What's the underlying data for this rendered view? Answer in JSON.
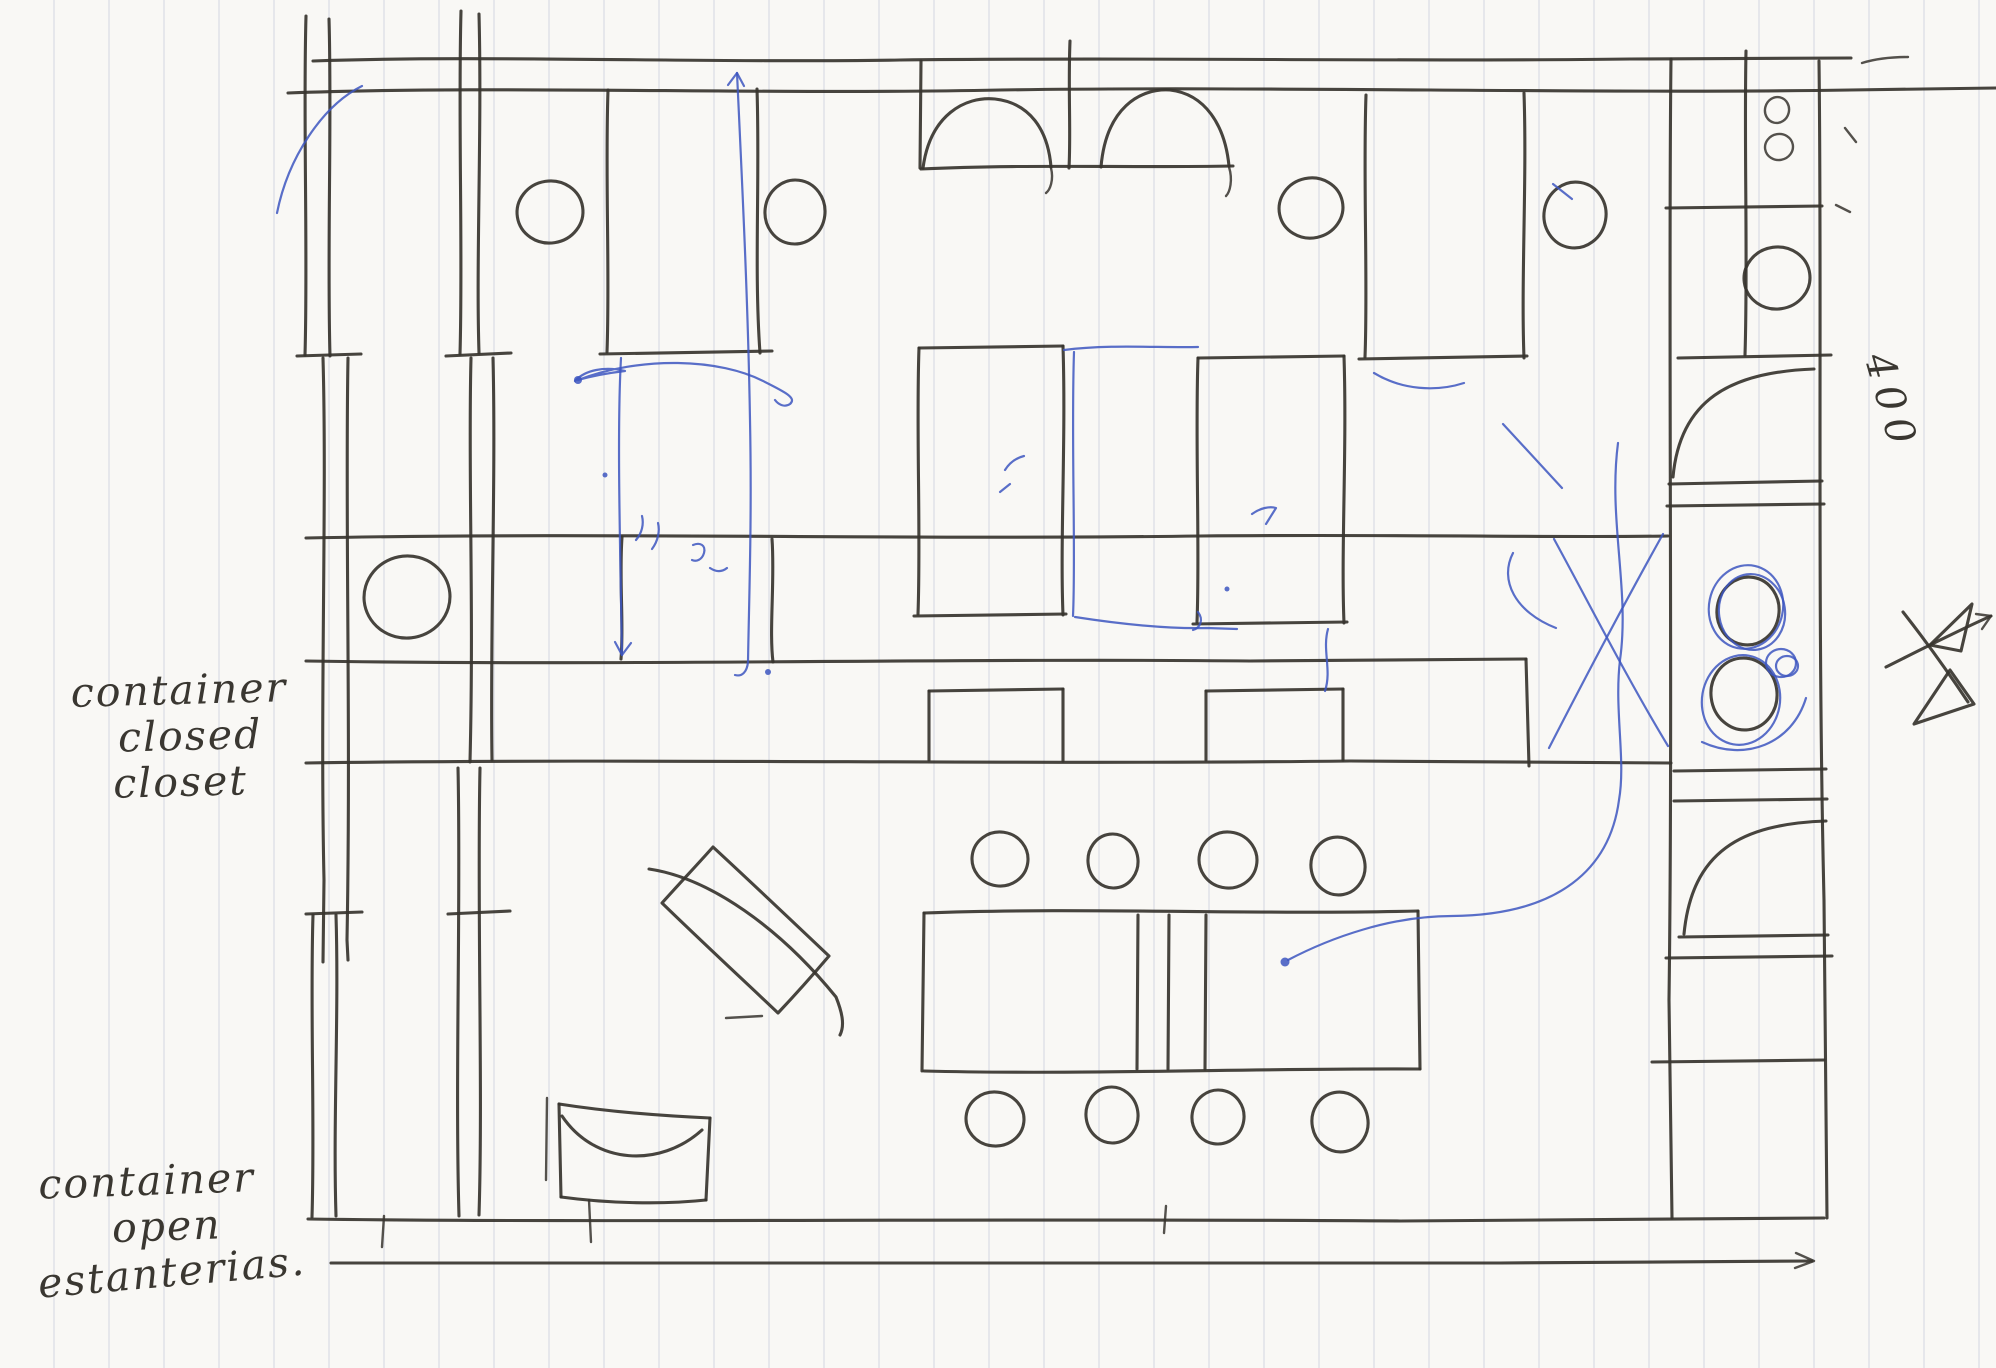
{
  "annotations": {
    "closed_container_label": {
      "line1": "container",
      "line2": "closed",
      "line3": "closet"
    },
    "open_container_label": {
      "line1": "container",
      "line2": "open",
      "line3": "estanterias."
    },
    "dimension_label": "400"
  },
  "colors": {
    "paper": "#f9f8f5",
    "rule_line": "#bac0d4",
    "ink_black": "#37342e",
    "ink_blue": "#3d56c0"
  }
}
